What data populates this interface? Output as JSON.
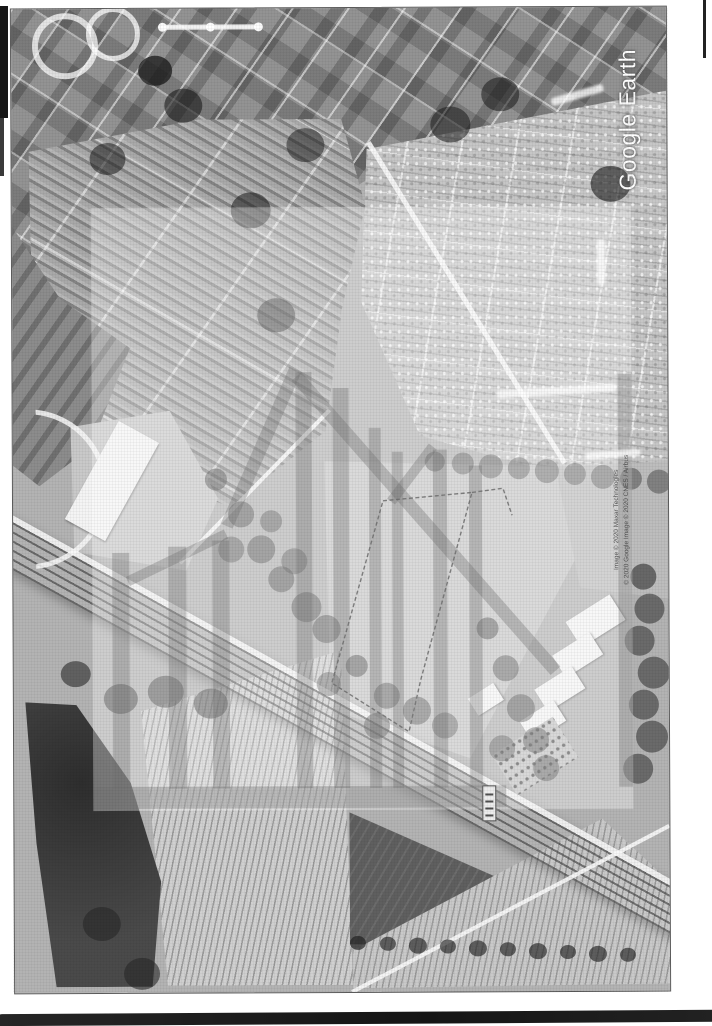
{
  "document": {
    "kind": "Scanned black-and-white Google Earth aerial photograph",
    "watermark": {
      "brand_text": "Google Earth"
    },
    "attribution": {
      "lines": [
        "Image © 2020 Maxar Technologies",
        "© 2020 Google",
        "Image © 2020 CNES / Airbus"
      ]
    }
  },
  "colors": {
    "page": "#ffffff",
    "photo_base": "#b3b3b3",
    "urban": "#939393",
    "residential": "#c6c6c6",
    "orchard": "#a9a9a9",
    "open_field": "#c7c7c7",
    "dark_field": "#5f5f5f",
    "river": "#2e2e2e",
    "watermark_overlay": "rgba(255,255,255,0.34)",
    "watermark_logo": "rgba(112,112,112,0.34)",
    "boundary_line": "#3c3c3c"
  },
  "map_features": {
    "site_boundary": "dashed polygon around open field at image centre",
    "corridor": "railway and road corridor crossing lower half diagonally",
    "regions": [
      "dense urban grid (top left)",
      "suburban housing grid (top right)",
      "orchard blocks (centre left)",
      "open paddock with site boundary (centre)",
      "industrial buildings (centre right)",
      "river (bottom left)",
      "vineyards (bottom)",
      "dark ploughed field (bottom right)"
    ]
  }
}
